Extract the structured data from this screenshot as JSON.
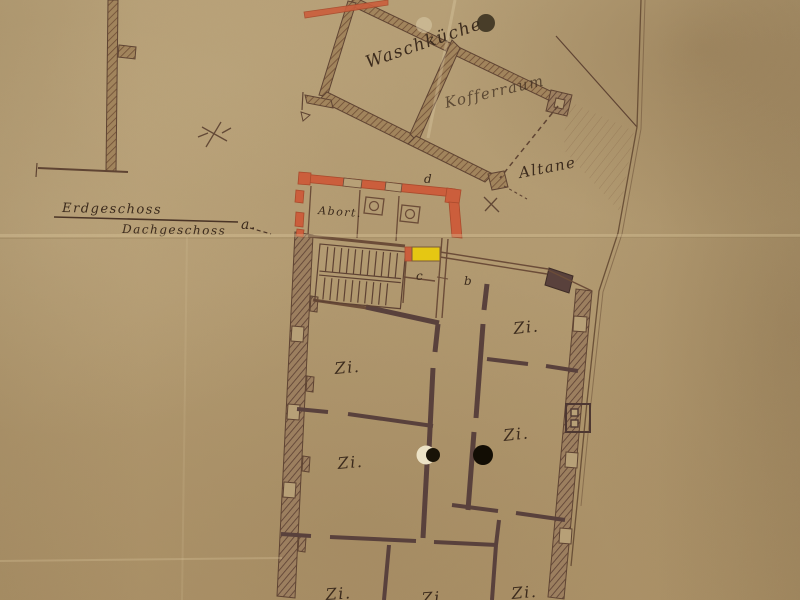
{
  "document": {
    "kind": "scanned hand-drawn floor plan",
    "language": "German"
  },
  "labels": {
    "floor_above_line": "Erdgeschoss",
    "floor_below_line": "Dachgeschoss",
    "laundry_room": "Waschküche",
    "trunk_room": "Kofferraum",
    "roof_terrace": "Altane",
    "toilet": "Abort.",
    "zimmer": "Zi.",
    "marker_a": "a.",
    "marker_b": "b",
    "marker_c": "c",
    "marker_d": "d"
  },
  "colors": {
    "paper": "#b29a72",
    "ink": "#3c2b1d",
    "line_ink": "#6b4c38",
    "wall_fill": "#a1845c",
    "wall_hatch": "#6f4e35",
    "dark_wall": "#59413c",
    "red_wall": "#cb5e3c",
    "red_wall_edge": "#a94a2c",
    "yellow_highlight": "#e5c713",
    "boundary": "#6b5138"
  }
}
